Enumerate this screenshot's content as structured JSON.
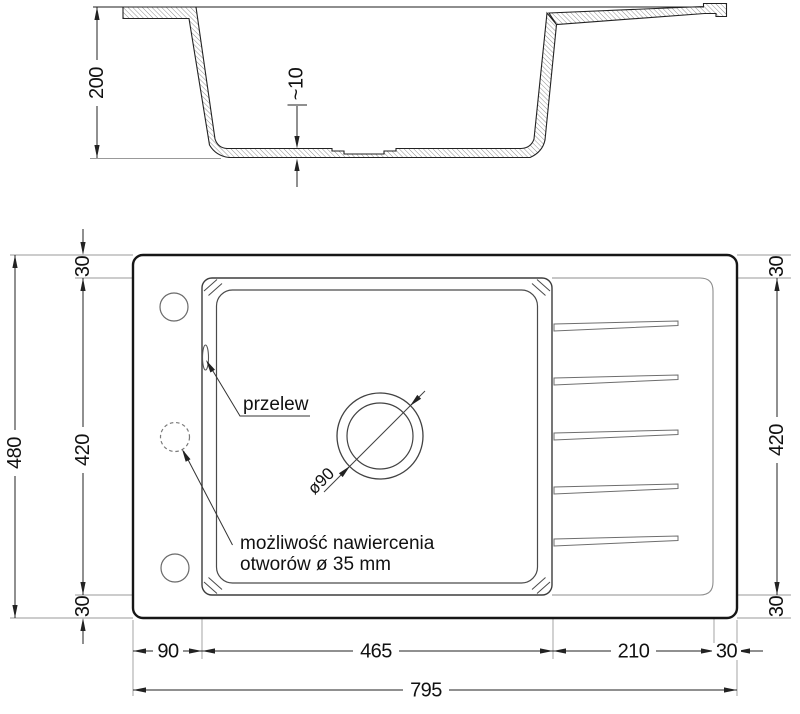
{
  "drawing": {
    "section": {
      "depth": "200",
      "bottom_thickness": "~10"
    },
    "plan": {
      "width_dims": {
        "deck": "90",
        "basin": "465",
        "drainer": "210",
        "margin": "30",
        "total": "795"
      },
      "height_dims": {
        "total": "480",
        "left_top_margin": "30",
        "left_inner": "420",
        "left_bottom_margin": "30",
        "right_top_margin": "30",
        "right_inner": "420",
        "right_bottom_margin": "30"
      },
      "labels": {
        "overflow": "przelew",
        "drill_note_line1": "możliwość nawiercenia",
        "drill_note_line2": "otworów ø 35 mm",
        "drain_diameter": "ø90"
      }
    },
    "colors": {
      "line": "#1c1c1c",
      "thin_line": "#8c8c8c",
      "hatch": "#6b6b6b",
      "background": "#ffffff"
    }
  }
}
